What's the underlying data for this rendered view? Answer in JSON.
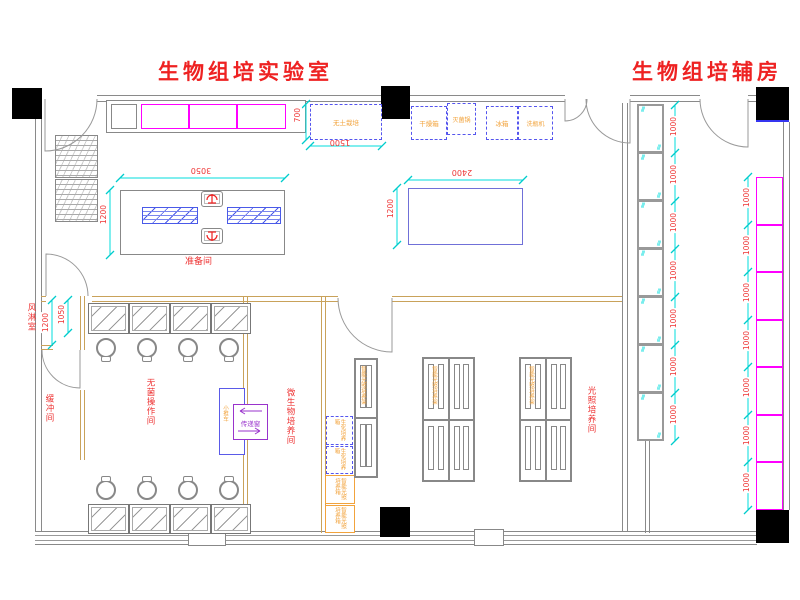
{
  "titles": {
    "lab": "生物组培实验室",
    "aux": "生物组培辅房"
  },
  "rooms": {
    "prep": "准备间",
    "air_shower": "风淋室",
    "buffer": "缓冲间",
    "sterile": "无菌操作间",
    "micro": "微生物培养间",
    "light": "光照培养间"
  },
  "equipment": {
    "soilless": "无土栽培",
    "dryer": "干燥箱",
    "sterilizer": "灭菌锅",
    "fridge": "冰箱",
    "bottle_washer": "洗瓶机",
    "transfer_window": "传递窗",
    "trolley": "小推车",
    "bio_incubator": "生化培养箱",
    "light_incubator": "智能光照培养箱",
    "light_rack": "智能光照培养架"
  },
  "dims": {
    "table1_w": "3050",
    "table1_d": "1200",
    "table2_w": "2400",
    "table2_d": "1200",
    "soilless_d": "700",
    "soilless_w": "1500",
    "air_shower_w": "1200",
    "bench_d": "1050",
    "module": "1000"
  },
  "colors": {
    "red": "#ee2222",
    "orange": "#f2a33c",
    "magenta": "#ff00ff",
    "cyan": "#00dddd",
    "blue": "#5a5ae0",
    "purple": "#9933cc",
    "wall_gray": "#8a8a8a",
    "wall_tan": "#c9a25a"
  }
}
